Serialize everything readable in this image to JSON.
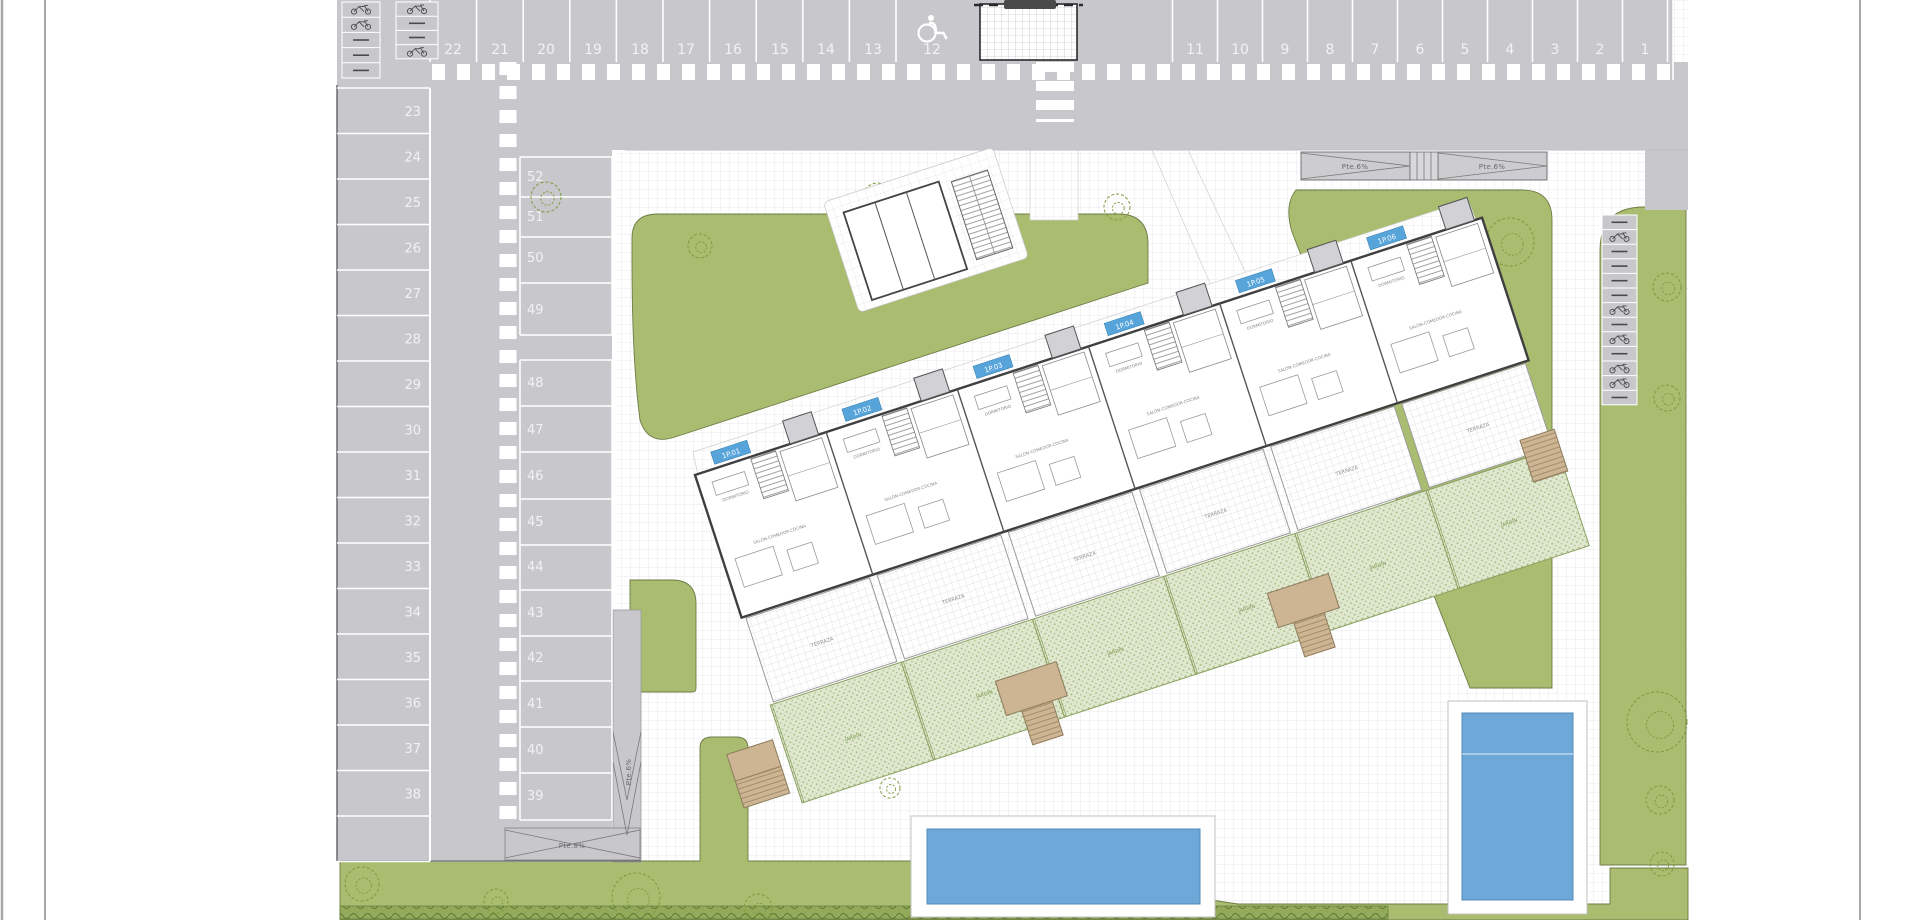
{
  "sheet": {
    "kind": "residential site plan drawing"
  },
  "parking": {
    "row_top_left": [
      "22",
      "21",
      "20",
      "19",
      "18",
      "17",
      "16",
      "15",
      "14",
      "13",
      "12"
    ],
    "row_top_right": [
      "11",
      "10",
      "9",
      "8",
      "7",
      "6",
      "5",
      "4",
      "3",
      "2",
      "1"
    ],
    "col_left": [
      "23",
      "24",
      "25",
      "26",
      "27",
      "28",
      "29",
      "30",
      "31",
      "32",
      "33",
      "34",
      "35",
      "36",
      "37",
      "38"
    ],
    "col_middle_upper": [
      "52",
      "51",
      "50",
      "49"
    ],
    "col_middle_lower": [
      "48",
      "47",
      "46",
      "45",
      "44",
      "43",
      "42",
      "41",
      "40",
      "39"
    ],
    "handicap_space": "12"
  },
  "ramps": {
    "slope_6": "Pte.6%",
    "slope_8": "Pte.8%"
  },
  "building": {
    "unit_badges": [
      "1P.01",
      "1P.02",
      "1P.03",
      "1P.04",
      "1P.05",
      "1P.06"
    ],
    "labels": {
      "living": "SALÓN-COMEDOR-COCINA",
      "bedroom": "DORMITORIO",
      "terrace": "TERRAZA",
      "garden": "JARDÍN"
    }
  },
  "icons": {
    "wheelchair": "wheelchair-icon",
    "bike_rack": "bike-rack-icon",
    "tree": "tree-icon",
    "crosswalk": "crosswalk-stripes"
  },
  "colors": {
    "asphalt": "#c8c8cc",
    "lawn": "#a9bc70",
    "garden": "#dfe8cf",
    "pool": "#6ea8d8",
    "stairs": "#cdb493",
    "badge": "#57a4da",
    "hedge": "#93aa5b"
  }
}
